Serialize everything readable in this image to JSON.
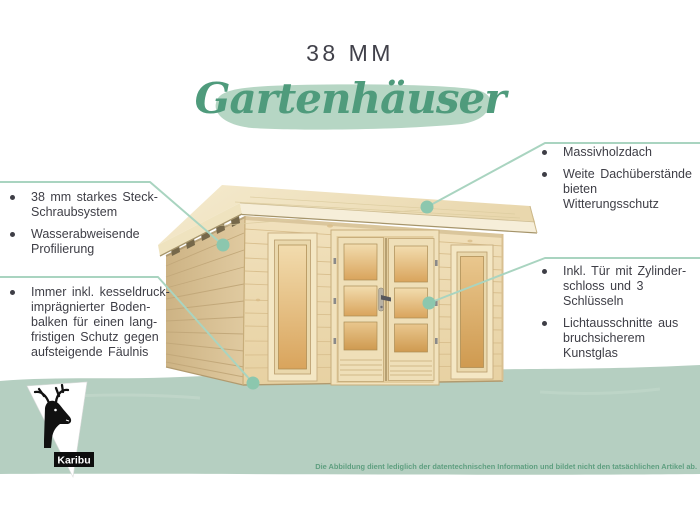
{
  "header": {
    "size_label": "38 MM",
    "title": "Gartenhäuser"
  },
  "callouts": {
    "left_top": {
      "items": [
        {
          "lines": [
            "38 mm starkes Steck-",
            "Schraubsystem"
          ]
        },
        {
          "lines": [
            "Wasserabweisende",
            "Profilierung"
          ]
        }
      ]
    },
    "left_bottom": {
      "items": [
        {
          "lines": [
            "Immer inkl. kesseldruck-",
            "imprägnierter Boden-",
            "balken für einen lang-",
            "fristigen Schutz gegen",
            "aufsteigende Fäulnis"
          ]
        }
      ]
    },
    "right_top": {
      "items": [
        {
          "lines": [
            "Massivholzdach"
          ]
        },
        {
          "lines": [
            "Weite Dachüberstände",
            "bieten Witterungsschutz"
          ]
        }
      ]
    },
    "right_bottom": {
      "items": [
        {
          "lines": [
            "Inkl. Tür mit Zylinder-",
            "schloss und 3 Schlüsseln"
          ]
        },
        {
          "lines": [
            "Lichtausschnitte aus",
            "bruchsicherem Kunstglas"
          ]
        }
      ]
    }
  },
  "footer": {
    "brand": "Karibu",
    "disclaimer": "Die Abbildung dient lediglich der datentechnischen Information und bildet nicht den tatsächlichen Artikel ab."
  },
  "colors": {
    "accent_line": "#a9d4c0",
    "accent_dot": "#8cc7ae",
    "band": "#b5cfc1",
    "title_green": "#4f9b7c",
    "brush": "#b6d6c4",
    "text": "#3e3e46",
    "disclaimer_green": "#5f9f80"
  }
}
